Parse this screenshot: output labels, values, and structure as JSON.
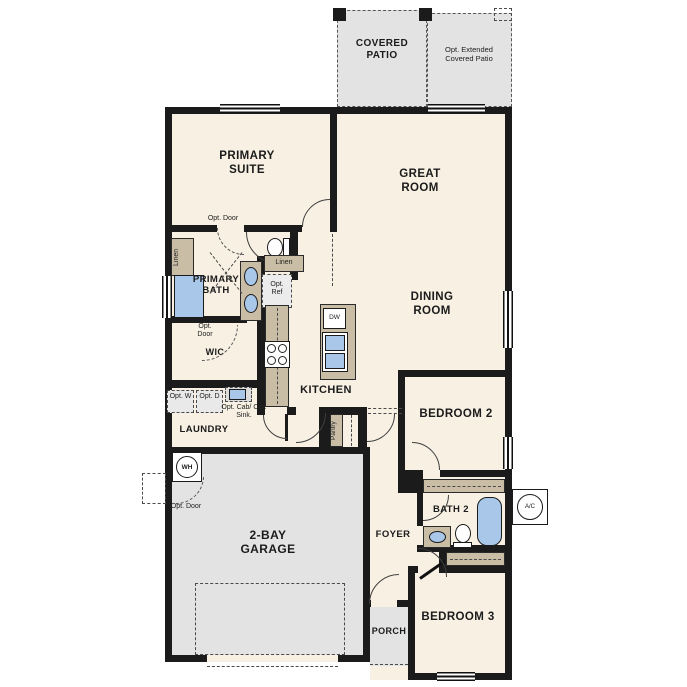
{
  "rooms": {
    "covered_patio": "COVERED PATIO",
    "opt_extended_patio": "Opt. Extended Covered Patio",
    "primary_suite": "PRIMARY SUITE",
    "great_room": "GREAT ROOM",
    "dining_room": "DINING ROOM",
    "primary_bath": "PRIMARY BATH",
    "wic": "WIC",
    "kitchen": "KITCHEN",
    "laundry": "LAUNDRY",
    "garage": "2-BAY GARAGE",
    "bedroom_2": "BEDROOM 2",
    "bath_2": "BATH 2",
    "foyer": "FOYER",
    "bedroom_3": "BEDROOM 3",
    "porch": "PORCH",
    "pantry": "Pantry"
  },
  "labels": {
    "linen_bath": "Linen",
    "linen_hall": "Linen",
    "opt_door_primary": "Opt. Door",
    "opt_door_wic": "Opt. Door",
    "opt_door_garage": "Opt. Door",
    "opt_ref": "Opt. Ref",
    "opt_washer": "Opt. W",
    "opt_dryer": "Opt. D",
    "opt_cab_sink": "Opt. Cab/ Opt. Sink.",
    "dishwasher": "DW",
    "water_heater": "WH",
    "ac": "A/C"
  },
  "colors": {
    "wall": "#1b1b1b",
    "floor": "#f7f0e3",
    "concrete": "#e3e3e3",
    "cabinet": "#c9bda5",
    "fixture_blue": "#a9c8e9"
  }
}
